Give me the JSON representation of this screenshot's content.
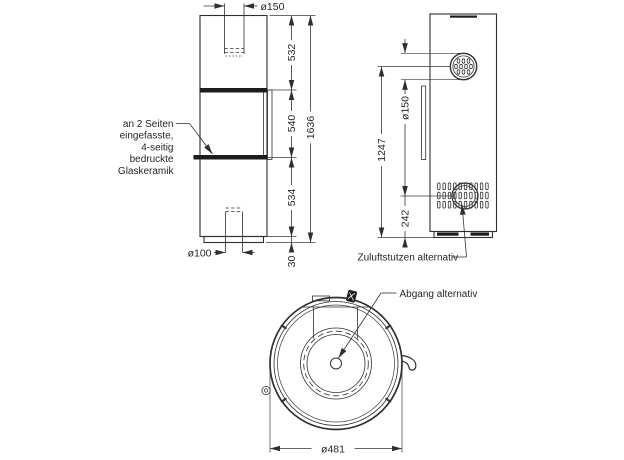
{
  "page": {
    "background": "#ffffff"
  },
  "drawing": {
    "line_color": "#2f2f2f",
    "text_color": "#262626",
    "front_view": {
      "dim_flue_diameter": "ø150",
      "dim_top_section": "532",
      "dim_glass_section": "540",
      "dim_lower_section": "534",
      "dim_base_height": "30",
      "dim_total_height": "1636",
      "dim_air_pipe_diameter": "ø100",
      "glass_note_line1": "an 2 Seiten",
      "glass_note_line2": "eingefasste,",
      "glass_note_line3": "4-seitig",
      "glass_note_line4": "bedruckte",
      "glass_note_line5": "Glaskeramik"
    },
    "side_view": {
      "dim_flue_diameter": "ø150",
      "dim_flue_center_height": "1247",
      "dim_air_inlet_height": "242",
      "air_inlet_note": "Zuluftstutzen alternativ"
    },
    "top_view": {
      "outlet_note": "Abgang alternativ",
      "dim_body_diameter": "ø481"
    }
  }
}
